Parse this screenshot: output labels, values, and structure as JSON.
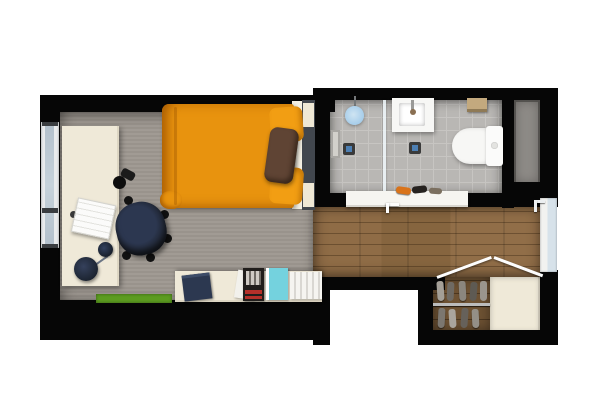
{
  "meta": {
    "description": "Top-down 3D rendered floor plan of a studio apartment with bedroom-study, bathroom, entry hallway and shoe closet",
    "view": "floor plan, plan view",
    "canvas": {
      "width": 600,
      "height": 420
    }
  },
  "colors": {
    "wall": "#060606",
    "carpet-a": "#a19b94",
    "carpet-b": "#99938c",
    "wood-a": "#8a6843",
    "wood-dark": "#6e5233",
    "tile": "#b9b7b4",
    "grout": "#c7c5c2",
    "shaft": "#8e8b87",
    "cream": "#efe9d8",
    "orange": "#e8930e",
    "orange-deep": "#c77a05",
    "pillow-orange": "#f29e13",
    "pillow-brown": "#5f4434",
    "headboard": "#42474e",
    "frame-white": "#f4f0e3",
    "chair-dark": "#1d222c",
    "chair-seat": "#2c3750",
    "window-pane": "#b3c0cb",
    "window-frame": "#e9ebec",
    "door-pane": "#d7e2ea",
    "shower-blue": "#a6cdea",
    "drain-blue": "#4d7fb3",
    "fixture-white": "#f7f7f5",
    "accent-green": "#5c9c20",
    "book-cyan": "#74d2de",
    "book-navy": "#2c3850",
    "mag-dark": "#211e1c",
    "mag-red": "#b5302a",
    "shelf-tan": "#c3a97e",
    "bench-white": "#f6f5f1",
    "sneaker-orange": "#d9731a"
  },
  "rooms": [
    {
      "name": "bedroom-study",
      "floor": "gray carpet",
      "items": [
        "single bed with orange duvet",
        "brown accent pillow",
        "two orange pillows",
        "dark headboard",
        "white desk",
        "laptop",
        "desk lamp",
        "camera",
        "black office chair",
        "green floor mat",
        "low white sideboard",
        "navy books",
        "magazine",
        "cyan book",
        "white book row",
        "window in left wall"
      ]
    },
    {
      "name": "bathroom",
      "floor": "gray tile",
      "items": [
        "shower head",
        "glass shower partition",
        "wall niche",
        "shower drain",
        "floor drain",
        "washbasin with faucet",
        "toilet bowl",
        "toilet cistern",
        "wall shelf above toilet"
      ]
    },
    {
      "name": "hallway-entry",
      "floor": "wood planks",
      "items": [
        "entry door with handle",
        "white bench with shoes",
        "wall hook"
      ]
    },
    {
      "name": "entry-closet",
      "floor": "wood",
      "items": [
        "open bifold doors shown as white lines",
        "shoe rack with rail",
        "shoe pairs",
        "built-in cream cabinet"
      ]
    },
    {
      "name": "service-shaft",
      "floor": "dark gray",
      "items": []
    }
  ]
}
